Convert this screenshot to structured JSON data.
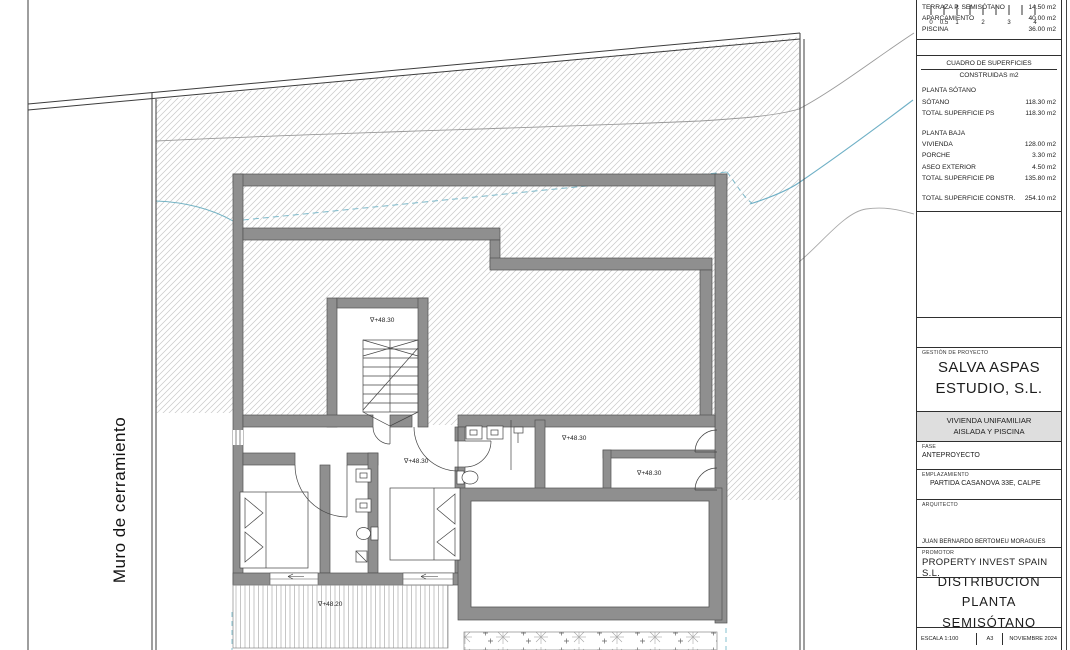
{
  "sheet": {
    "wall_label": "Muro de cerramiento"
  },
  "plan": {
    "levels": {
      "stairs": "∇+48.30",
      "bedrooms": "∇+48.30",
      "hall": "∇+48.30",
      "storage": "∇+48.30",
      "terrace": "∇+48.20"
    }
  },
  "titleblock": {
    "surfaces": [
      {
        "label": "TERRAZA P. SEMISÓTANO",
        "value": "14.50 m2"
      },
      {
        "label": "APARCAMIENTO",
        "value": "40.00 m2"
      },
      {
        "label": "PISCINA",
        "value": "36.00 m2"
      }
    ],
    "cuadro_title": "CUADRO DE SUPERFICIES",
    "cuadro_subtitle": "CONSTRUIDAS m2",
    "planta_sotano_heading": "PLANTA SÓTANO",
    "sotano_rows": [
      {
        "label": "SÓTANO",
        "value": "118.30 m2"
      },
      {
        "label": "TOTAL SUPERFICIE PS",
        "value": "118.30 m2"
      }
    ],
    "planta_baja_heading": "PLANTA BAJA",
    "baja_rows": [
      {
        "label": "VIVIENDA",
        "value": "128.00 m2"
      },
      {
        "label": "PORCHE",
        "value": "3.30 m2"
      },
      {
        "label": "ASEO EXTERIOR",
        "value": "4.50 m2"
      },
      {
        "label": "TOTAL SUPERFICIE PB",
        "value": "135.80 m2"
      }
    ],
    "total_row": {
      "label": "TOTAL SUPERFICIE CONSTR.",
      "value": "254.10 m2"
    },
    "scalebar_labels": [
      "0",
      "0.5",
      "1",
      "2",
      "3",
      "4"
    ],
    "gestion_label": "GESTIÓN DE PROYECTO",
    "studio_line1": "SALVA ASPAS",
    "studio_line2": "ESTUDIO, S.L.",
    "project_line1": "VIVIENDA UNIFAMILIAR",
    "project_line2": "AISLADA Y PISCINA",
    "fase_label": "FASE",
    "fase_value": "ANTEPROYECTO",
    "emplazamiento_label": "EMPLAZAMIENTO",
    "emplazamiento_value": "PARTIDA CASANOVA 33E, CALPE",
    "arquitecto_label": "ARQUITECTO",
    "arquitecto_value": "JUAN BERNARDO BERTOMEU MORAGUES",
    "promotor_label": "PROMOTOR",
    "promotor_value": "PROPERTY INVEST SPAIN S.L.",
    "title_line1": "DISTRIBUCIÓN",
    "title_line2": "PLANTA SEMISÓTANO",
    "escala": "ESCALA 1:100",
    "formato": "A3",
    "fecha": "NOVIEMBRE 2024"
  },
  "colors": {
    "wall": "#8f8f8f",
    "contour_blue": "#74b3c4",
    "hatch_line": "#c9c9c9"
  }
}
